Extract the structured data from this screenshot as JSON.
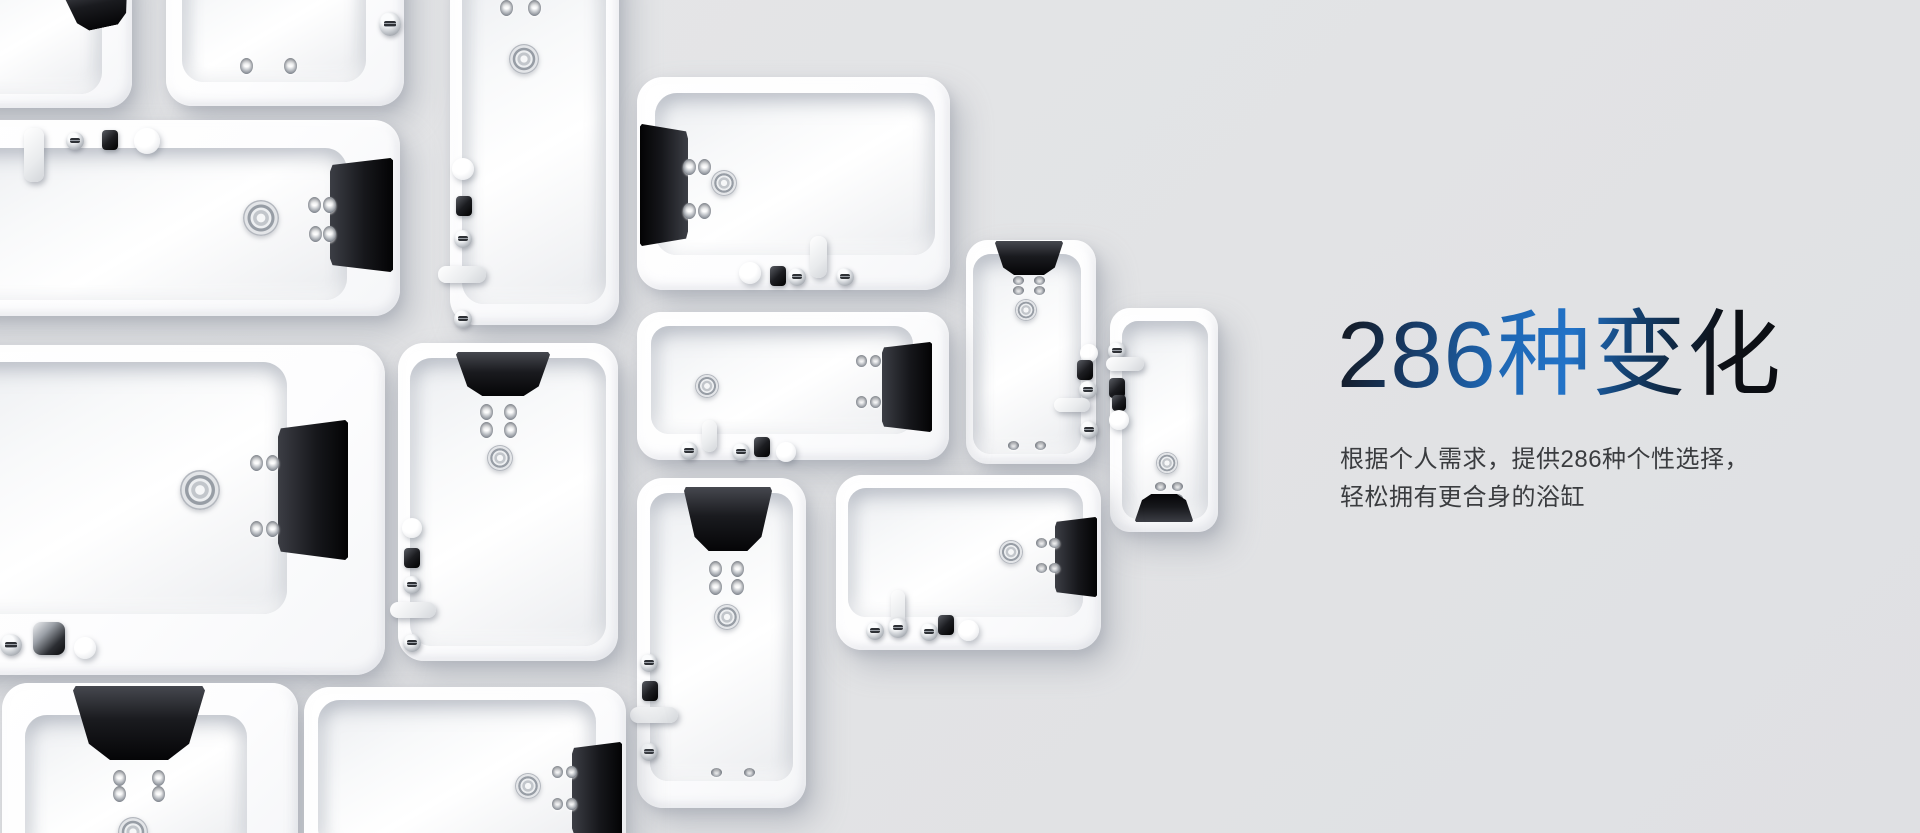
{
  "banner": {
    "title": "286种变化",
    "subtitle_lines": [
      "根据个人需求，提供286种个性选择，",
      "轻松拥有更合身的浴缸"
    ]
  },
  "style_tokens": {
    "background": "#e3e4e6",
    "title_gradient": [
      "#14161c",
      "#17375f",
      "#1e66b2",
      "#2273c8",
      "#133e6b",
      "#0d1016"
    ],
    "subtitle_color": "#3a3c3f",
    "tub_color": "#ffffff",
    "basin_shade_color": "#eceef1",
    "headrest_color": "#0c0c0f",
    "chrome_color": "#c6cacf"
  },
  "gallery": {
    "bathtub_count": 14
  }
}
